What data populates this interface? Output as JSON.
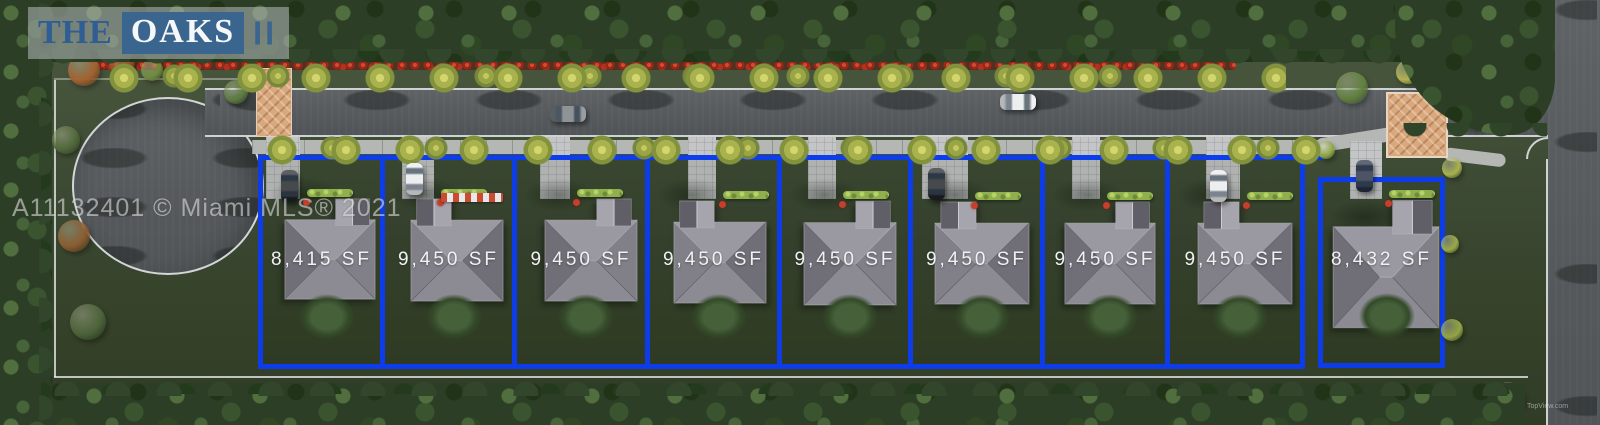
{
  "logo": {
    "prefix": "THE",
    "name": "OAKS",
    "suffix": "II"
  },
  "watermark": {
    "mls_text": "A11132401 © Miami MLS® 2021",
    "corner_text": "TopView.com"
  },
  "lots": [
    {
      "id": 1,
      "sf": "8,415 SF",
      "car": "black"
    },
    {
      "id": 2,
      "sf": "9,450 SF",
      "car": "white"
    },
    {
      "id": 3,
      "sf": "9,450 SF",
      "car": null
    },
    {
      "id": 4,
      "sf": "9,450 SF",
      "car": null
    },
    {
      "id": 5,
      "sf": "9,450 SF",
      "car": null
    },
    {
      "id": 6,
      "sf": "9,450 SF",
      "car": "black"
    },
    {
      "id": 7,
      "sf": "9,450 SF",
      "car": null
    },
    {
      "id": 8,
      "sf": "9,450 SF",
      "car": "white"
    },
    {
      "id": 9,
      "sf": "8,432 SF",
      "car": "darkblue"
    }
  ],
  "road_cars": [
    {
      "color": "gray"
    },
    {
      "color": "white"
    }
  ],
  "colors": {
    "lot_boundary": "#0d3ceb",
    "logo_blue": "#3a658f",
    "label_text": "#f1f1f2",
    "asphalt": "#595d60",
    "sidewalk": "#b5b7b5",
    "crosswalk_paver": "#d9a87d"
  }
}
